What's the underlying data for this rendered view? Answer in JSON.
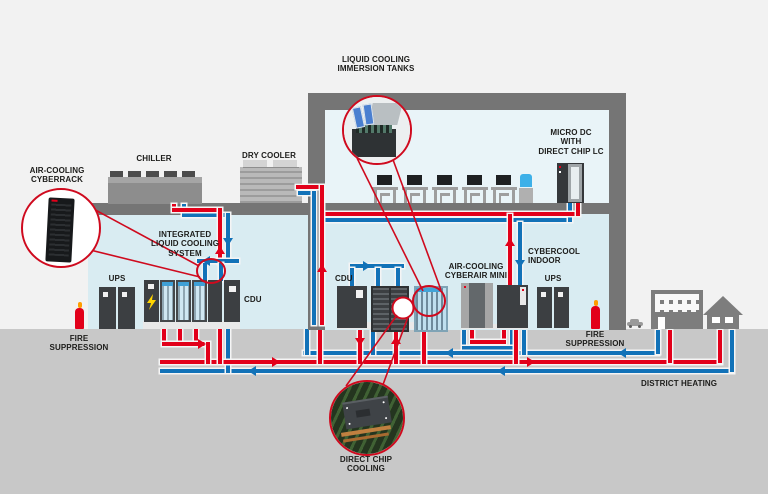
{
  "labels": {
    "air_cooling_cyberrack": "AIR-COOLING\nCYBERRACK",
    "chiller": "CHILLER",
    "dry_cooler": "DRY COOLER",
    "immersion_tanks": "LIQUID COOLING\nIMMERSION TANKS",
    "micro_dc": "MICRO DC\nWITH\nDIRECT CHIP LC",
    "integrated_lcs": "INTEGRATED\nLIQUID COOLING\nSYSTEM",
    "ups_left": "UPS",
    "fire_suppression_left": "FIRE\nSUPPRESSION",
    "cdu_left": "CDU",
    "cdu_mid": "CDU",
    "cyberair_mini": "AIR-COOLING\nCYBERAIR MINI",
    "cybercool_indoor": "CYBERCOOL\nINDOOR",
    "ups_right": "UPS",
    "fire_suppression_right": "FIRE\nSUPPRESSION",
    "district_heating": "DISTRICT HEATING",
    "direct_chip_cooling": "DIRECT CHIP\nCOOLING"
  },
  "colors": {
    "pipe_hot": "#e2001a",
    "pipe_cold": "#1272b8",
    "callout_ring": "#cf0a1e",
    "structure": "#757575",
    "room": "#d9ecf2",
    "ground": "#c8c8c8",
    "cabinet": "#3c3f42",
    "lightning": "#ffd500"
  },
  "callouts": {
    "left_photo": "server-rack-photo",
    "top_photo": "immersion-tank-photo",
    "bottom_photo": "cpu-cold-plate-photo"
  }
}
